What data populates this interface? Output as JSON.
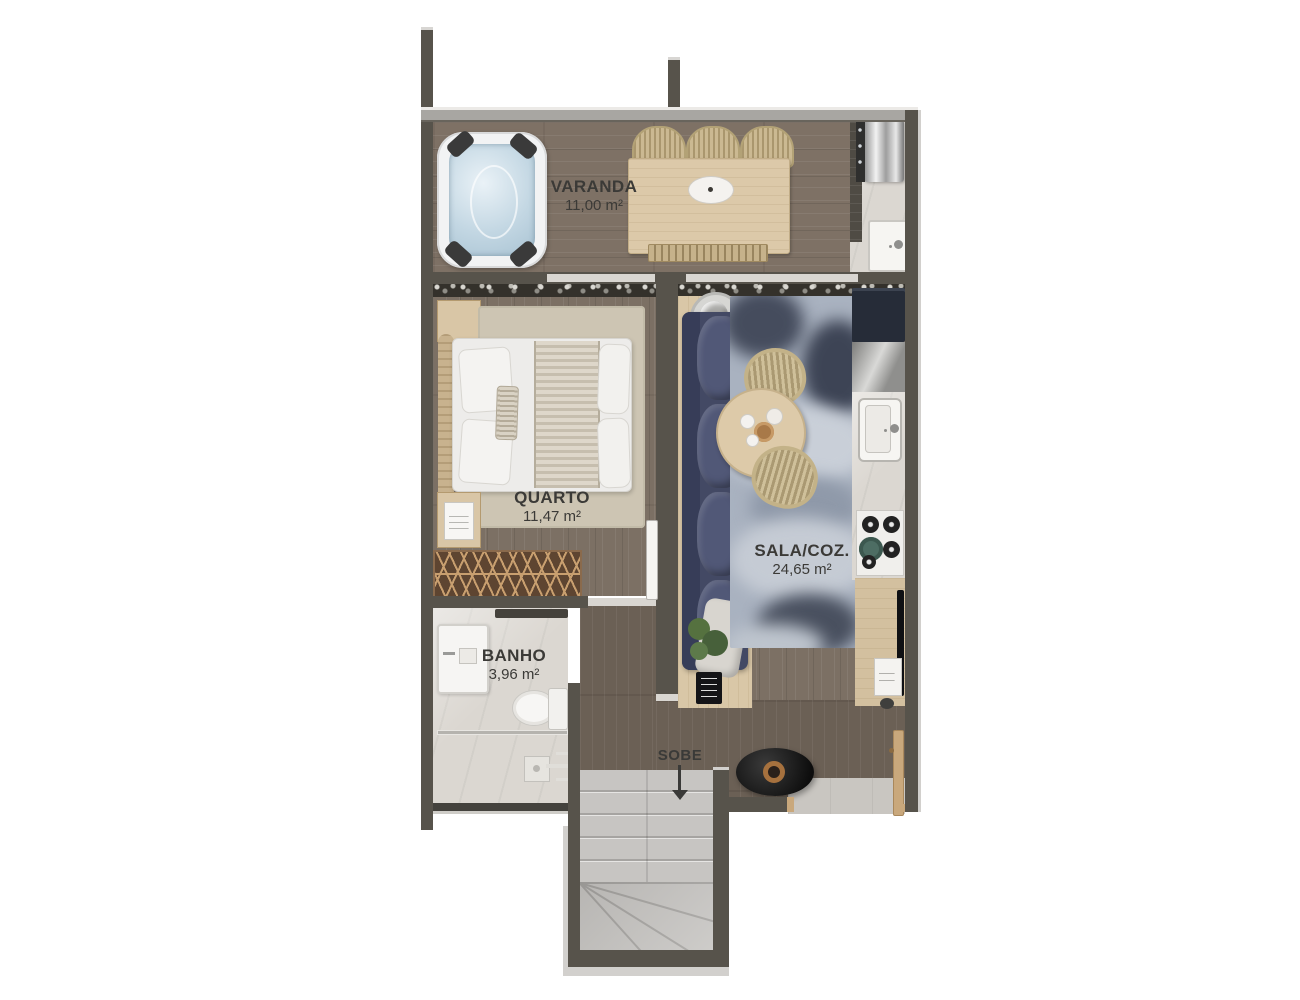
{
  "plan_title": "apartment-upper-floor-plan",
  "rooms": [
    {
      "id": "varanda",
      "name": "VARANDA",
      "area": "11,00 m²"
    },
    {
      "id": "quarto",
      "name": "QUARTO",
      "area": "11,47 m²"
    },
    {
      "id": "sala",
      "name": "SALA/COZ.",
      "area": "24,65 m²"
    },
    {
      "id": "banho",
      "name": "BANHO",
      "area": "3,96 m²"
    }
  ],
  "stairs": {
    "label": "SOBE",
    "direction": "arrow-down"
  },
  "palette": {
    "background": "#ffffff",
    "wall": "#57534b",
    "wall_outer_edge": "#d2d0cd",
    "wood_floor": "#7e7165",
    "corridor_floor": "#6b6055",
    "bathroom_floor": "#dbd7d1",
    "stairs_floor": "#c7c5c2",
    "marble_counter": "#d6d3ce",
    "sofa_navy": "#495071",
    "rug_blue": "#a9b2c0",
    "wood_furniture": "#d9c7a7",
    "door_wood": "#c9a87c",
    "label_text": "#3b3a37"
  },
  "furniture": {
    "varanda": [
      "hot-tub",
      "outdoor-dining-table",
      "dining-chairs",
      "bench",
      "barbecue-grill",
      "outdoor-sink"
    ],
    "quarto": [
      "double-bed",
      "headboard",
      "nightstand",
      "bedroom-rug",
      "wardrobe"
    ],
    "banho": [
      "washbasin",
      "toilet",
      "shower",
      "glass-partition"
    ],
    "sala_coz": [
      "sofa",
      "area-rug",
      "round-dining-table",
      "rattan-chairs",
      "plant",
      "fridge",
      "kitchen-counter",
      "kitchen-sink",
      "cooktop",
      "sideboard",
      "tv"
    ],
    "hall": [
      "decor-fire-bowl",
      "entry-door"
    ],
    "stairs": [
      "staircase-with-winders"
    ]
  }
}
